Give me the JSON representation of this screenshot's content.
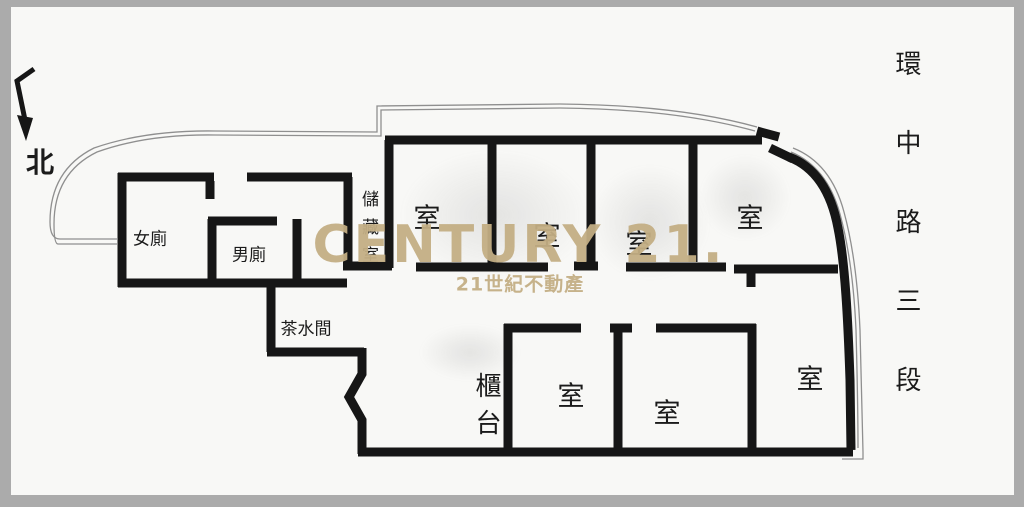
{
  "meta": {
    "kind": "real-estate floor plan"
  },
  "colors": {
    "wall": "#161616",
    "site_boundary": "#8f8f8f",
    "paper": "#f8f8f6",
    "frame": "#ababab",
    "watermark": "#c3ae84"
  },
  "compass": {
    "label": "北"
  },
  "labels": {
    "women_toilet": "女廁",
    "men_toilet": "男廁",
    "storage_room": "儲藏室",
    "pantry": "茶水間",
    "counter": "櫃台",
    "room_top_1": "室",
    "room_top_2": "室",
    "room_top_3": "室",
    "room_top_4": "室",
    "room_bottom_1": "室",
    "room_bottom_2": "室",
    "room_bottom_3": "室"
  },
  "street": {
    "name": "環中路三段"
  },
  "watermark": {
    "brand": "CENTURY 21.",
    "subtitle": "21世紀不動產"
  }
}
